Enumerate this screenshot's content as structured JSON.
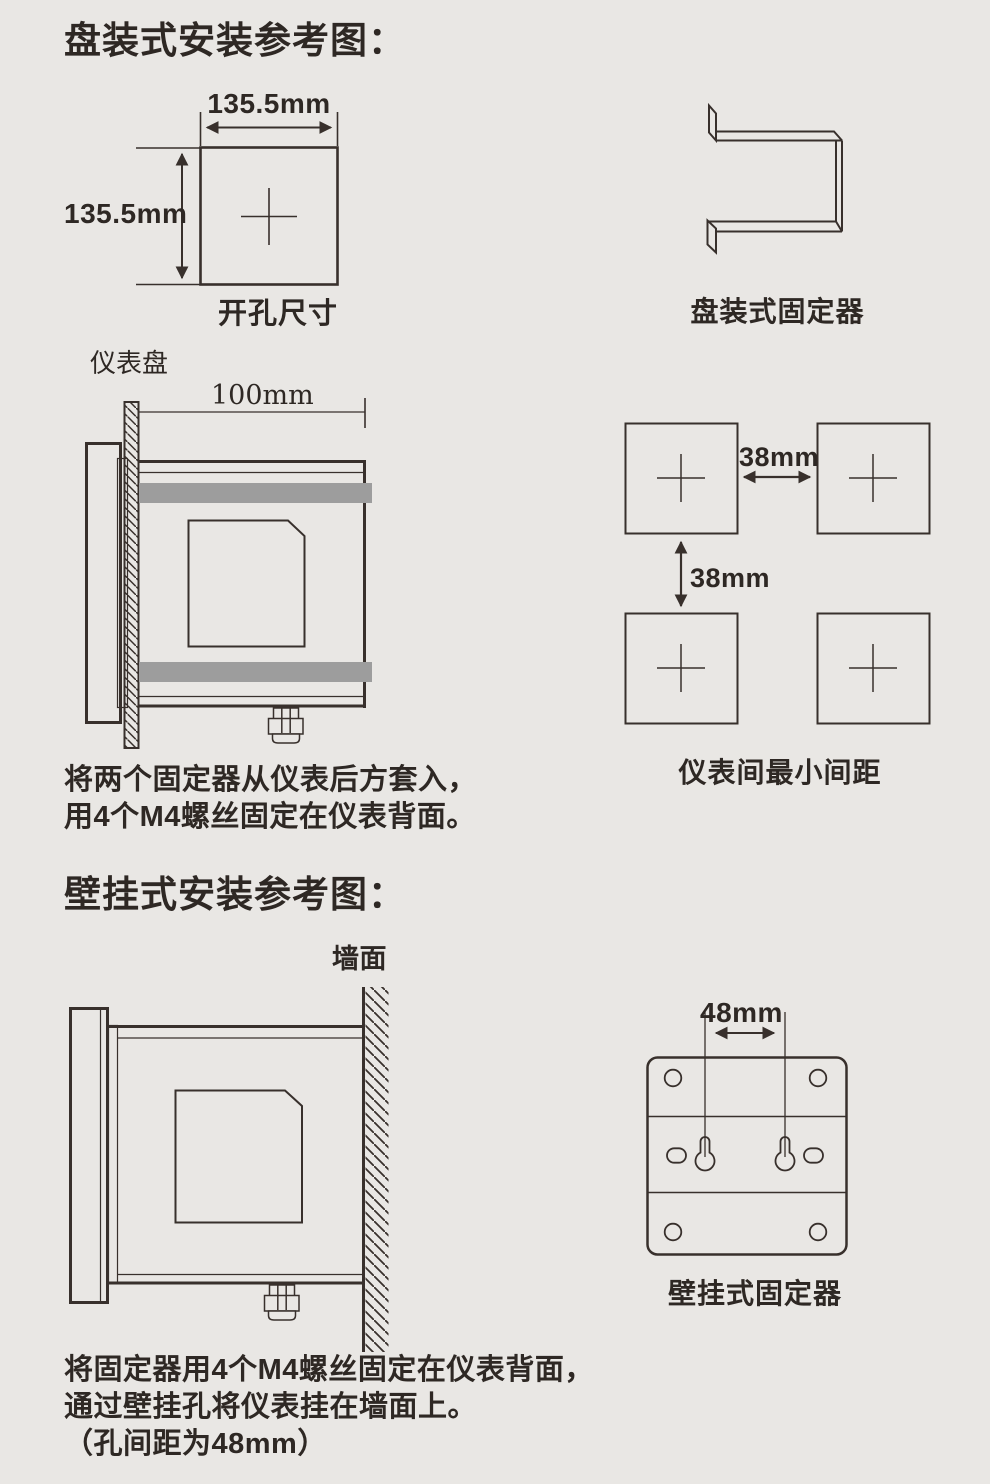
{
  "colors": {
    "background": "#e9e7e4",
    "ink": "#38302c",
    "fixture_bar": "#9d9d9d"
  },
  "panel_section": {
    "title": "盘装式安装参考图：",
    "cutout": {
      "width_dim": "135.5mm",
      "height_dim": "135.5mm",
      "caption": "开孔尺寸"
    },
    "bracket": {
      "caption": "盘装式固定器"
    },
    "side_view": {
      "panel_label": "仪表盘",
      "depth_dim": "100mm"
    },
    "spacing": {
      "horizontal_dim": "38mm",
      "vertical_dim": "38mm",
      "caption": "仪表间最小间距"
    },
    "instructions": [
      "将两个固定器从仪表后方套入，",
      "用4个M4螺丝固定在仪表背面。"
    ]
  },
  "wall_section": {
    "title": "壁挂式安装参考图：",
    "wall_label": "墙面",
    "plate": {
      "hole_spacing_dim": "48mm",
      "caption": "壁挂式固定器"
    },
    "instructions": [
      "将固定器用4个M4螺丝固定在仪表背面，",
      "通过壁挂孔将仪表挂在墙面上。",
      "（孔间距为48mm）"
    ]
  }
}
